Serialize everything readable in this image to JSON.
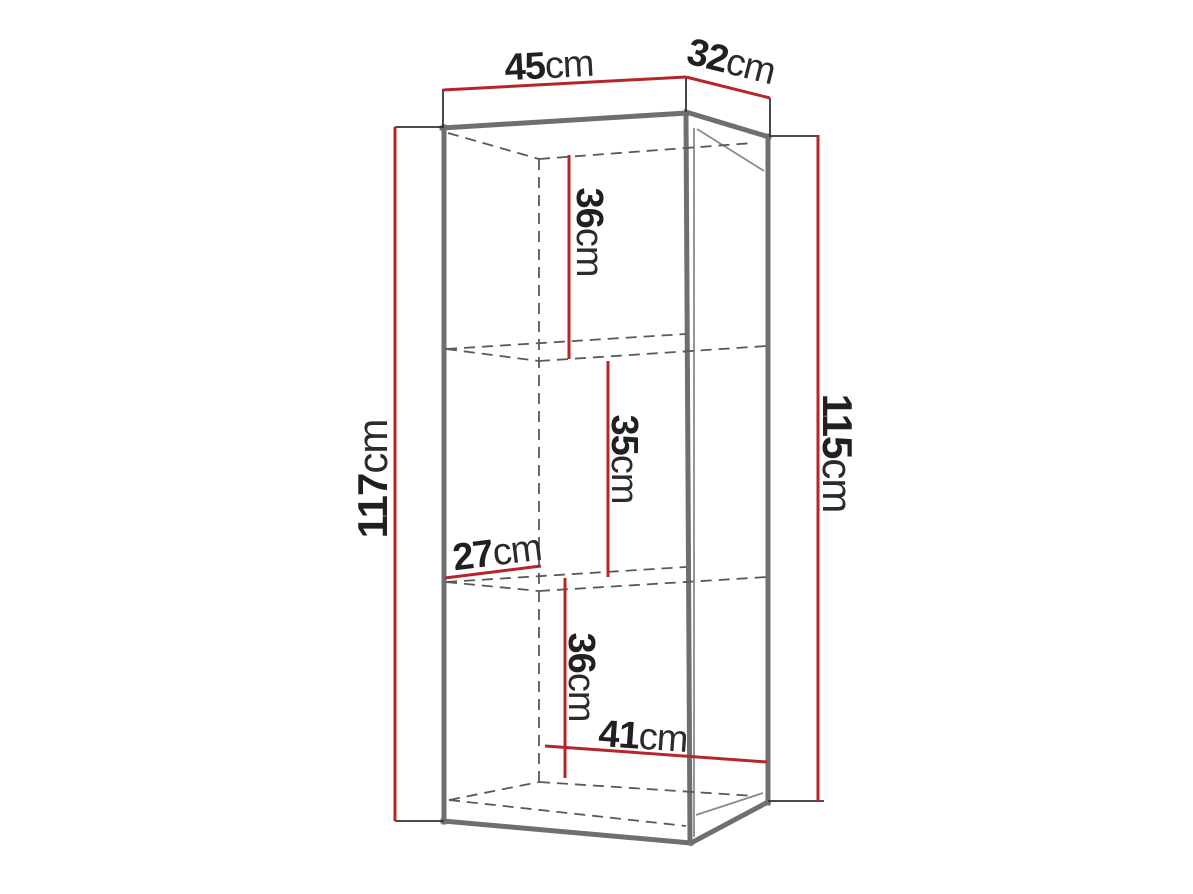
{
  "diagram": {
    "title": "cabinet-dimension-diagram",
    "unit": "cm",
    "colors": {
      "dimension_line": "#b5252a",
      "cabinet_outline": "#6e6f71",
      "hidden_edge": "#59595b",
      "label_text": "#231f20",
      "background": "#ffffff"
    },
    "dims": {
      "top_width": {
        "value": "45",
        "unit": "cm"
      },
      "top_depth": {
        "value": "32",
        "unit": "cm"
      },
      "height_left": {
        "value": "117",
        "unit": "cm"
      },
      "height_right": {
        "value": "115",
        "unit": "cm"
      },
      "shelf_top": {
        "value": "36",
        "unit": "cm"
      },
      "shelf_middle": {
        "value": "35",
        "unit": "cm"
      },
      "shelf_bottom": {
        "value": "36",
        "unit": "cm"
      },
      "inner_depth": {
        "value": "27",
        "unit": "cm"
      },
      "inner_width": {
        "value": "41",
        "unit": "cm"
      }
    }
  }
}
